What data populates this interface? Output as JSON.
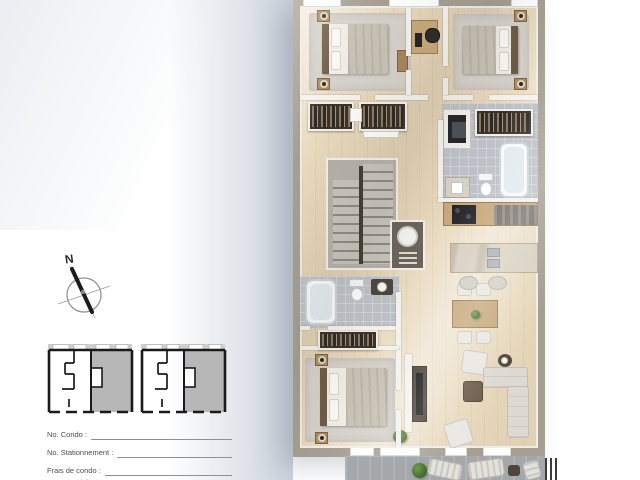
{
  "compass": {
    "north_label": "N"
  },
  "form": {
    "fields": [
      {
        "label": "No. Condo :"
      },
      {
        "label": "No. Stationnement :"
      },
      {
        "label": "Frais de condo :"
      },
      {
        "label": "Taxes scolaires :"
      }
    ]
  },
  "palette": {
    "outer_wall": "#a69e92",
    "wood_floor": "#e8d9bd",
    "tile_floor": "#bdc1c7",
    "left_shadow": "#c6ced8",
    "keyplan_highlight": "#b7b7b7",
    "balcony_floor": "#a4a8ab"
  }
}
